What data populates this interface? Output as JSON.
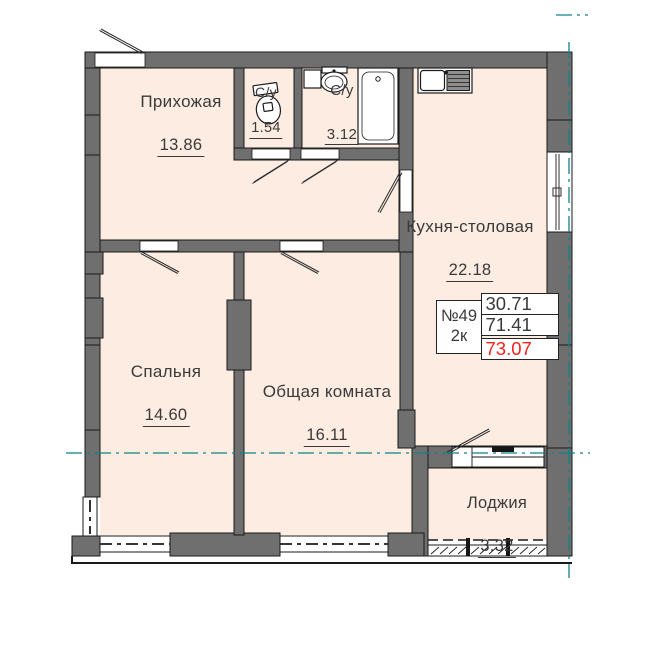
{
  "plan_title": "План 2-комнатной квартиры №49",
  "rooms": {
    "hallway": {
      "label": "Прихожая",
      "area": "13.86"
    },
    "wc_small": {
      "label": "С/у",
      "area": "1.54"
    },
    "wc_big": {
      "label": "С/у",
      "area": "3.12"
    },
    "kitchen": {
      "label": "Кухня-столовая",
      "area": "22.18"
    },
    "bedroom": {
      "label": "Спальня",
      "area": "14.60"
    },
    "living": {
      "label": "Общая комната",
      "area": "16.11"
    },
    "loggia": {
      "label": "Лоджия",
      "area": "3.32"
    }
  },
  "info_box": {
    "apartment_number": "№49",
    "rooms_count": "2к",
    "living_area": "30.71",
    "floor_area": "71.41",
    "total_area": "73.07"
  },
  "colors": {
    "floor": "#fcece2",
    "wall": "#6f6f6f",
    "outline": "#1a1a1a",
    "axis": "#0e8389",
    "red": "#f5221d",
    "text": "#3a3a3a"
  },
  "icons": {
    "toilet-icon": "toilet plan symbol",
    "washing-machine-icon": "washer square plan symbol",
    "bathroom-sink-icon": "wash basin oval plan symbol",
    "bathtub-icon": "bathtub plan symbol",
    "kitchen-sink-icon": "double kitchen sink with drainboard",
    "door-swing-icon": "door leaf swing line",
    "axis-line-icon": "teal dash-dot structural axis line",
    "loggia-glazing-icon": "hatched loggia glazing band"
  }
}
